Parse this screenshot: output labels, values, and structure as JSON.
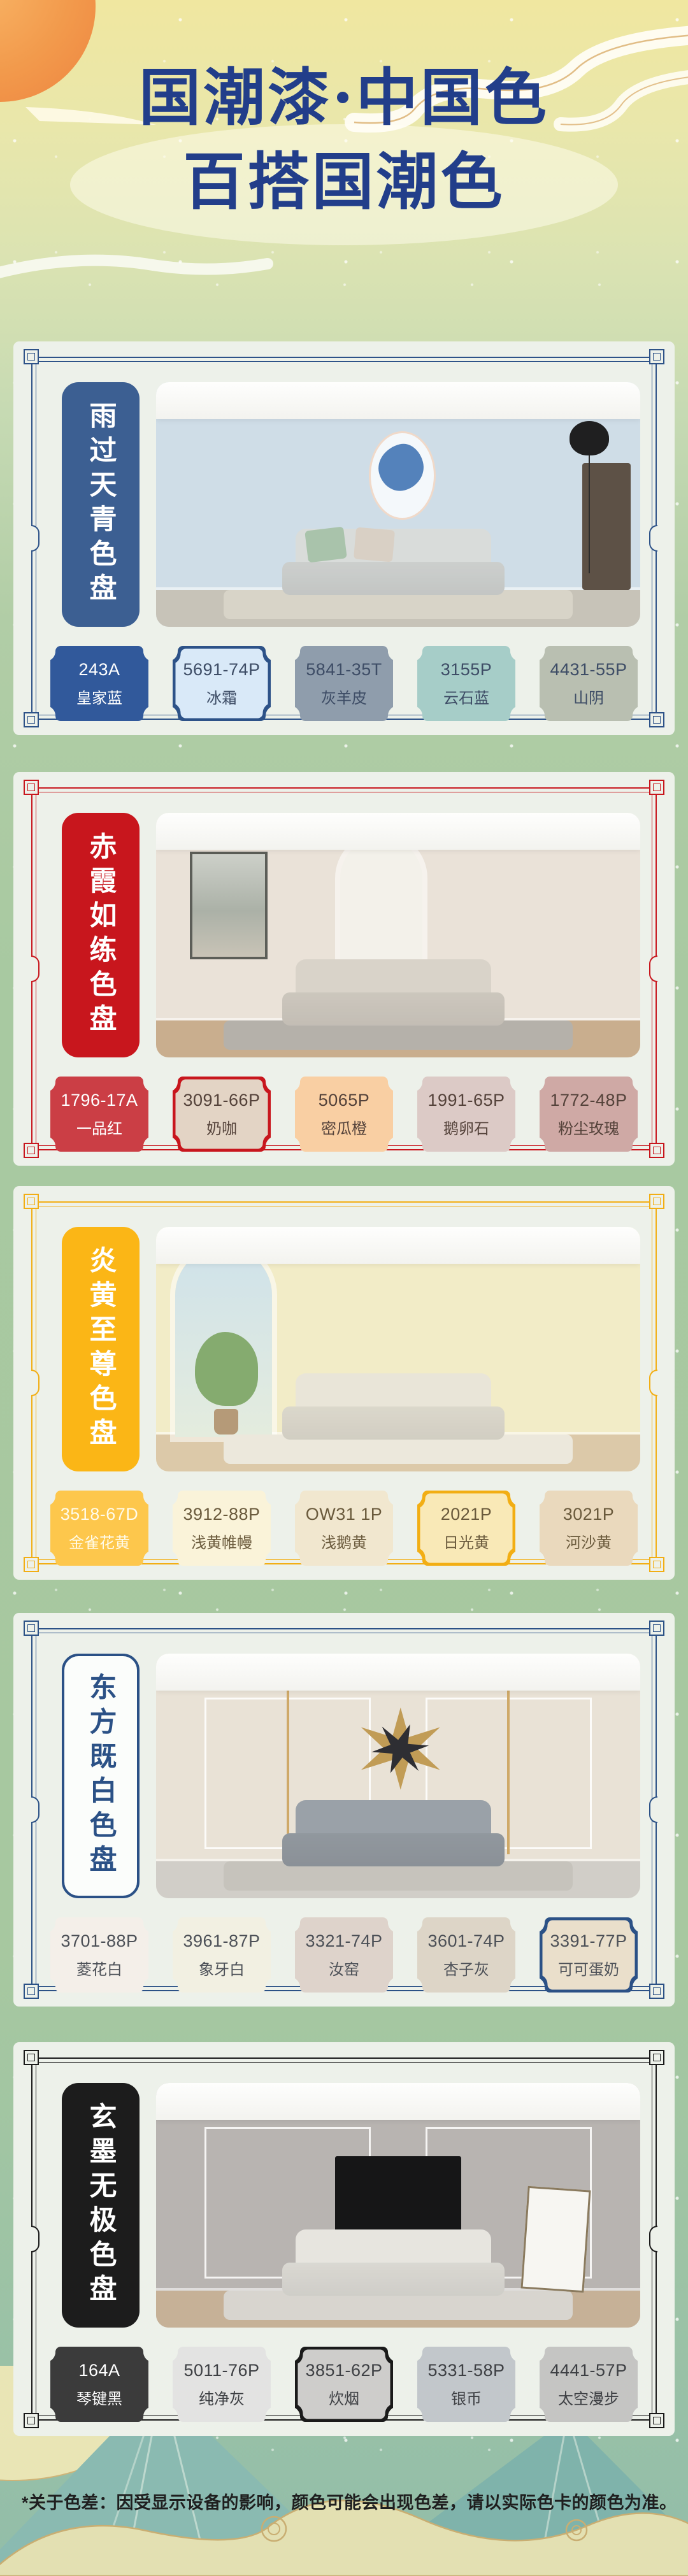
{
  "header": {
    "title_line1": "国潮漆·中国色",
    "title_line2": "百搭国潮色",
    "title_color": "#223e8a"
  },
  "footer": {
    "disclaimer": "*关于色差：因受显示设备的影响，颜色可能会出现色差，请以实际色卡的颜色为准。"
  },
  "sections": [
    {
      "name": "雨过天青色盘",
      "accent": "#2d5288",
      "card": {
        "bg": "#3c5f92",
        "text_color": "#ffffff",
        "style": "filled"
      },
      "ink_color": "#3e4d66",
      "swatches": [
        {
          "code": "243A",
          "name": "皇家蓝",
          "bg": "#31599b",
          "text_color": "#ffffff",
          "highlight": false
        },
        {
          "code": "5691-74P",
          "name": "冰霜",
          "bg": "#d9e9f8",
          "highlight": true
        },
        {
          "code": "5841-35T",
          "name": "灰羊皮",
          "bg": "#8f9dac",
          "highlight": false
        },
        {
          "code": "3155P",
          "name": "云石蓝",
          "bg": "#a6cdc8",
          "highlight": false
        },
        {
          "code": "4431-55P",
          "name": "山阴",
          "bg": "#b9bfb1",
          "highlight": false
        }
      ]
    },
    {
      "name": "赤霞如练色盘",
      "accent": "#c8161d",
      "card": {
        "bg": "#c8161d",
        "text_color": "#ffffff",
        "style": "filled"
      },
      "ink_color": "#54423a",
      "swatches": [
        {
          "code": "1796-17A",
          "name": "一品红",
          "bg": "#cb3e45",
          "text_color": "#ffffff",
          "highlight": false
        },
        {
          "code": "3091-66P",
          "name": "奶咖",
          "bg": "#e3d4c5",
          "highlight": true
        },
        {
          "code": "5065P",
          "name": "密瓜橙",
          "bg": "#f9cfa3",
          "highlight": false
        },
        {
          "code": "1991-65P",
          "name": "鹅卵石",
          "bg": "#dccac6",
          "highlight": false
        },
        {
          "code": "1772-48P",
          "name": "粉尘玫瑰",
          "bg": "#cfa9a5",
          "highlight": false
        }
      ]
    },
    {
      "name": "炎黄至尊色盘",
      "accent": "#f2ae14",
      "card": {
        "bg": "#fbb616",
        "text_color": "#ffffff",
        "style": "filled"
      },
      "ink_color": "#6a5a3c",
      "swatches": [
        {
          "code": "3518-67D",
          "name": "金雀花黄",
          "bg": "#fdc74c",
          "text_color": "#fffbe9",
          "highlight": false
        },
        {
          "code": "3912-88P",
          "name": "浅黄帷幔",
          "bg": "#faf3d9",
          "highlight": false
        },
        {
          "code": "OW31 1P",
          "name": "浅鹅黄",
          "bg": "#f1e7cf",
          "highlight": false
        },
        {
          "code": "2021P",
          "name": "日光黄",
          "bg": "#f9e9b7",
          "highlight": true
        },
        {
          "code": "3021P",
          "name": "河沙黄",
          "bg": "#ead9bd",
          "highlight": false
        }
      ]
    },
    {
      "name": "东方既白色盘",
      "accent": "#2b5186",
      "card": {
        "bg": "#fbfdfb",
        "text_color": "#2b5186",
        "style": "outline"
      },
      "ink_color": "#4c5057",
      "swatches": [
        {
          "code": "3701-88P",
          "name": "菱花白",
          "bg": "#f4efe9",
          "highlight": false
        },
        {
          "code": "3961-87P",
          "name": "象牙白",
          "bg": "#f2f0e2",
          "highlight": false
        },
        {
          "code": "3321-74P",
          "name": "汝窑",
          "bg": "#ded3cb",
          "highlight": false
        },
        {
          "code": "3601-74P",
          "name": "杏子灰",
          "bg": "#ddd5c7",
          "highlight": false
        },
        {
          "code": "3391-77P",
          "name": "可可蛋奶",
          "bg": "#eadfcb",
          "highlight": true
        }
      ]
    },
    {
      "name": "玄墨无极色盘",
      "accent": "#1a1a1a",
      "card": {
        "bg": "#1c1c1c",
        "text_color": "#ffffff",
        "style": "filled"
      },
      "ink_color": "#3e4044",
      "swatches": [
        {
          "code": "164A",
          "name": "琴键黑",
          "bg": "#3b3b3b",
          "text_color": "#ffffff",
          "highlight": false
        },
        {
          "code": "5011-76P",
          "name": "纯净灰",
          "bg": "#e3e3e2",
          "highlight": false
        },
        {
          "code": "3851-62P",
          "name": "炊烟",
          "bg": "#cecdcb",
          "highlight": true
        },
        {
          "code": "5331-58P",
          "name": "银币",
          "bg": "#c2c7cb",
          "highlight": false
        },
        {
          "code": "4441-57P",
          "name": "太空漫步",
          "bg": "#c5c5c3",
          "highlight": false
        }
      ]
    }
  ]
}
